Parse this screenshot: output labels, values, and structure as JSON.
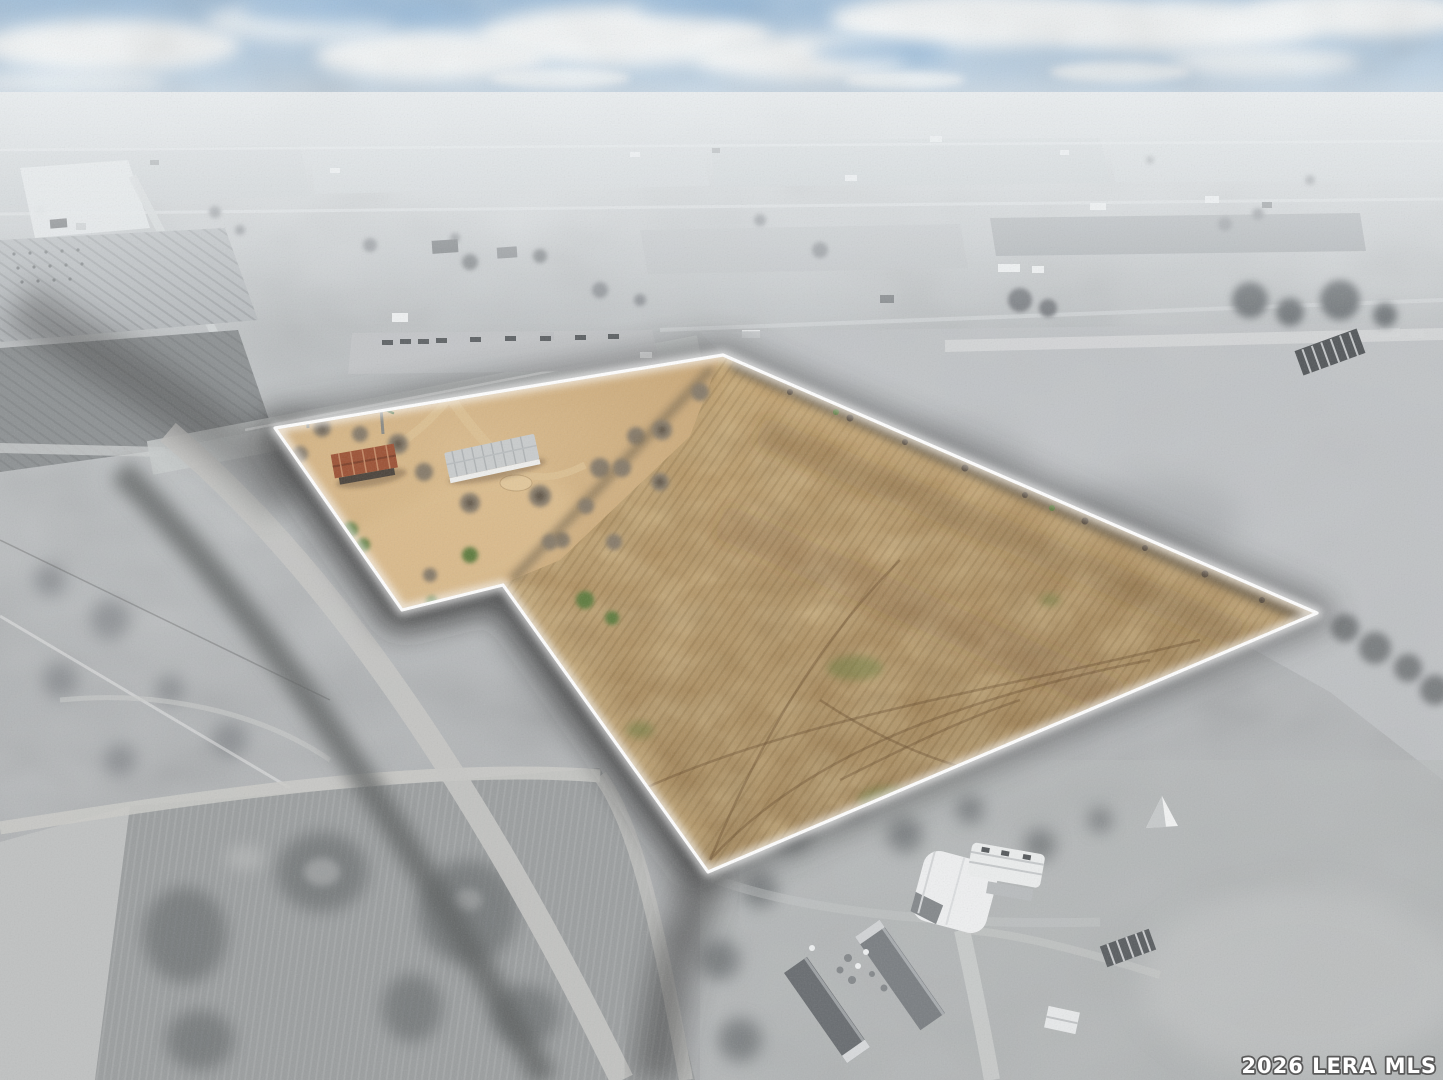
{
  "watermark": {
    "text": "2026 LERA MLS"
  },
  "scene": {
    "description": "aerial drone photo of rural acreage; flag-shaped listing parcel shown in color with white glowing boundary over desaturated gray farmland; winter fields, farmhouse, barn, palm trees; pale blue cloudy sky at horizon",
    "sky": {
      "top": "#9fc0de",
      "horizon": "#e6ecf0",
      "clouds": "#f7fafb"
    },
    "landscape": {
      "base": "#b5b8ba",
      "dark_shadow": "#2f2f2f"
    },
    "parcel": {
      "points": "275,428 723,355 1317,613 708,872 503,585 402,610",
      "outline": "#ffffff",
      "field": "#aa8a5c",
      "yard": "#d3b286",
      "barn_roof": "#9c5134",
      "house_roof": "#c9cccd",
      "greens": "#5d7a3e",
      "features": [
        "plowed brown field",
        "sandy house yard",
        "white mobile home",
        "rust-roof barn",
        "two palm trees",
        "bare winter trees",
        "green brush patches",
        "tire tracks"
      ]
    }
  }
}
